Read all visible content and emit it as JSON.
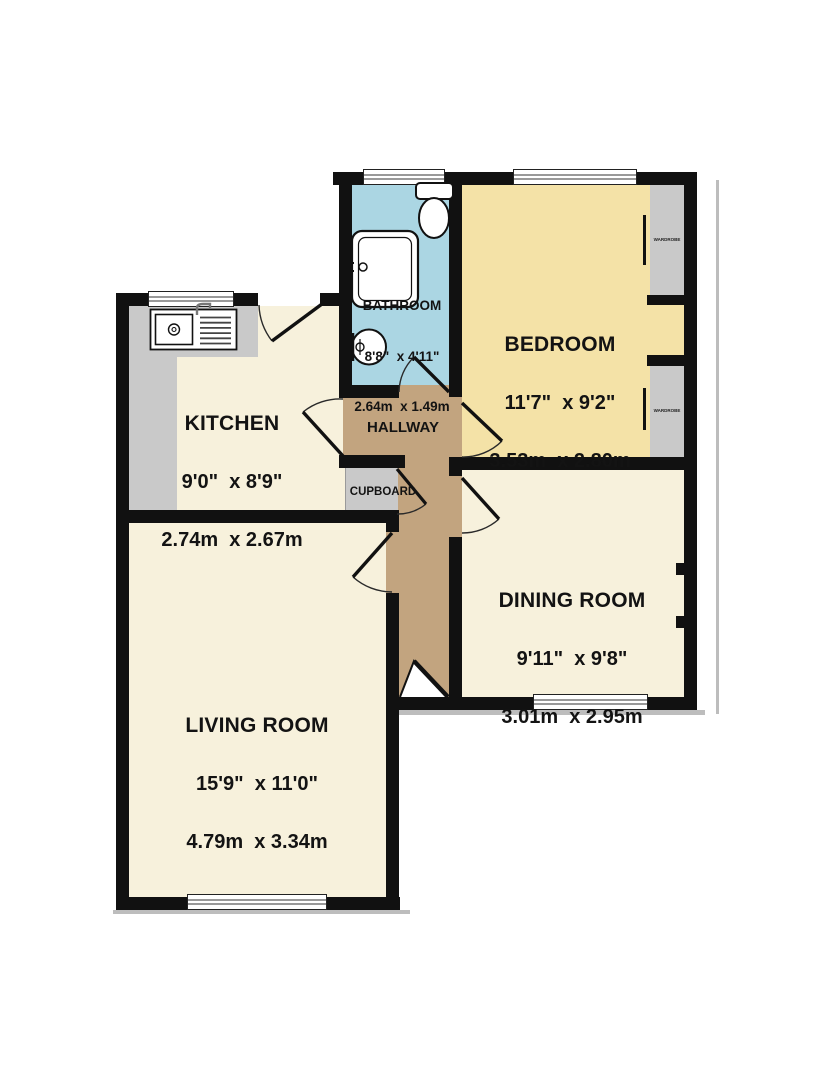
{
  "plan": {
    "rooms": [
      {
        "id": "bathroom",
        "name": "BATHROOM",
        "imperial": "8'8\"  x 4'11\"",
        "metric": "2.64m  x 1.49m"
      },
      {
        "id": "bedroom",
        "name": "BEDROOM",
        "imperial": "11'7\"  x 9'2\"",
        "metric": "3.53m  x 2.80m"
      },
      {
        "id": "kitchen",
        "name": "KITCHEN",
        "imperial": "9'0\"  x 8'9\"",
        "metric": "2.74m  x 2.67m"
      },
      {
        "id": "hallway",
        "name": "HALLWAY"
      },
      {
        "id": "cupboard",
        "name": "CUPBOARD"
      },
      {
        "id": "dining",
        "name": "DINING ROOM",
        "imperial": "9'11\"  x 9'8\"",
        "metric": "3.01m  x 2.95m"
      },
      {
        "id": "living",
        "name": "LIVING ROOM",
        "imperial": "15'9\"  x 11'0\"",
        "metric": "4.79m  x 3.34m"
      }
    ],
    "fixtures": [
      {
        "id": "wardrobe-1",
        "label": "WARDROBE"
      },
      {
        "id": "wardrobe-2",
        "label": "WARDROBE"
      }
    ],
    "colors": {
      "wall": "#111111",
      "bathroom": "#abd6e3",
      "bedroom": "#f4e2a7",
      "cream": "#f7f1dc",
      "hallway": "#c2a47f",
      "unit_gray": "#c9c9c9",
      "window_line": "#999999",
      "shadow": "#bdbdbd"
    }
  }
}
